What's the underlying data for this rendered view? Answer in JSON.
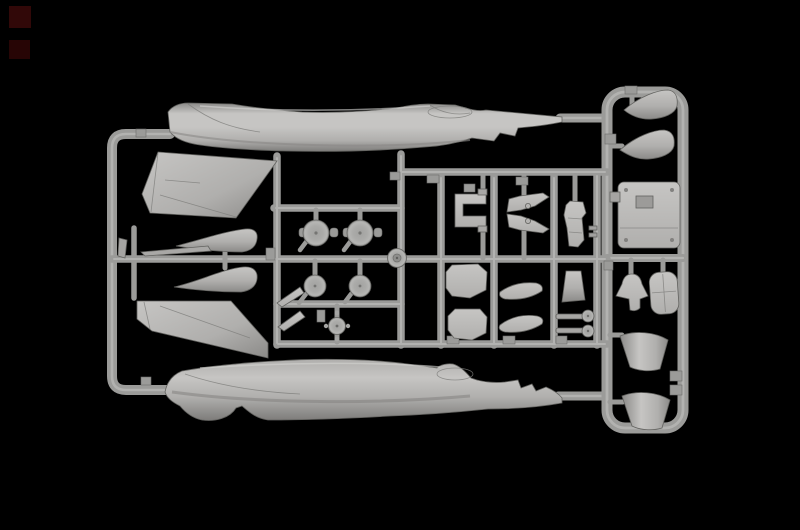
{
  "scene": {
    "background_color": "#000000",
    "runner_color": "#9b9b99",
    "runner_highlight": "#c9c9c7",
    "plastic_light": "#c6c5c3",
    "plastic_mid": "#aaa9a7",
    "plastic_dark": "#8b8a88",
    "corner_mark_top_color": "#310808",
    "corner_mark_bottom_color": "#270505"
  },
  "sprue": {
    "material": "light grey plastic",
    "background": "black",
    "parts": [
      {
        "name": "fuselage-half-upper"
      },
      {
        "name": "fuselage-half-lower"
      },
      {
        "name": "tail-fin-half-upper"
      },
      {
        "name": "tail-fin-half-lower"
      },
      {
        "name": "nose-cone-half-1"
      },
      {
        "name": "nose-cone-half-2"
      },
      {
        "name": "thin-stabilizer"
      },
      {
        "name": "small-blade-left"
      },
      {
        "name": "main-wheel-1"
      },
      {
        "name": "main-wheel-2"
      },
      {
        "name": "wheel-disc-1"
      },
      {
        "name": "wheel-disc-2"
      },
      {
        "name": "hub-disc"
      },
      {
        "name": "nose-wheel"
      },
      {
        "name": "pitot-blade-1"
      },
      {
        "name": "pitot-blade-2"
      },
      {
        "name": "intake-splitter-bracket"
      },
      {
        "name": "gear-door-pair"
      },
      {
        "name": "ejection-seat"
      },
      {
        "name": "hatch-panel-1"
      },
      {
        "name": "hatch-panel-2"
      },
      {
        "name": "canopy-side-panel-1"
      },
      {
        "name": "canopy-side-panel-2"
      },
      {
        "name": "stabilizer-fin-small"
      },
      {
        "name": "actuator-rod-1"
      },
      {
        "name": "actuator-rod-2"
      },
      {
        "name": "radome-half-1"
      },
      {
        "name": "radome-half-2"
      },
      {
        "name": "cockpit-tub"
      },
      {
        "name": "control-column"
      },
      {
        "name": "seat-cushion"
      },
      {
        "name": "exhaust-nozzle-half-1"
      },
      {
        "name": "exhaust-nozzle-half-2"
      }
    ]
  }
}
